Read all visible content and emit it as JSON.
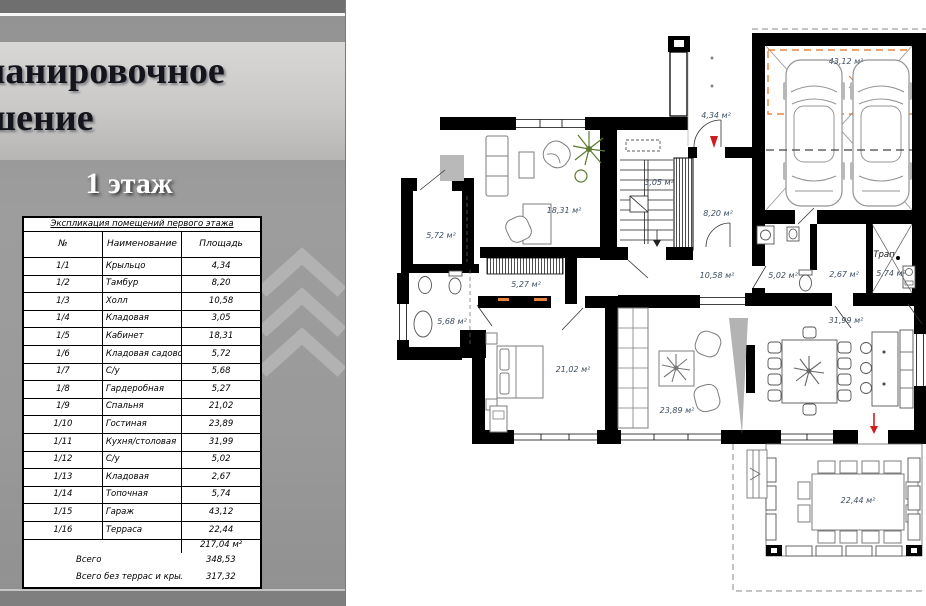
{
  "panel": {
    "title_line1": "ланировочное",
    "title_line2": "шение",
    "floor_label": "1 этаж",
    "table": {
      "title": "Экспликация помещений первого этажа",
      "columns": [
        "№",
        "Наименование",
        "Площадь"
      ],
      "rows": [
        [
          "1/1",
          "Крыльцо",
          "4,34"
        ],
        [
          "1/2",
          "Тамбур",
          "8,20"
        ],
        [
          "1/3",
          "Холл",
          "10,58"
        ],
        [
          "1/4",
          "Кладовая",
          "3,05"
        ],
        [
          "1/5",
          "Кабинет",
          "18,31"
        ],
        [
          "1/6",
          "Кладовая садового инвентаря",
          "5,72"
        ],
        [
          "1/7",
          "С/у",
          "5,68"
        ],
        [
          "1/8",
          "Гардеробная",
          "5,27"
        ],
        [
          "1/9",
          "Спальня",
          "21,02"
        ],
        [
          "1/10",
          "Гостиная",
          "23,89"
        ],
        [
          "1/11",
          "Кухня/столовая",
          "31,99"
        ],
        [
          "1/12",
          "С/у",
          "5,02"
        ],
        [
          "1/13",
          "Кладовая",
          "2,67"
        ],
        [
          "1/14",
          "Топочная",
          "5,74"
        ],
        [
          "1/15",
          "Гараж",
          "43,12"
        ],
        [
          "1/16",
          "Терраса",
          "22,44"
        ]
      ],
      "subtotal_area": "217,04 м²",
      "totals": [
        {
          "label": "Всего",
          "value": "348,53"
        },
        {
          "label": "Всего без террас и крылец",
          "value": "317,32"
        }
      ]
    }
  },
  "plan": {
    "room_labels": [
      {
        "text": "43,12 м²",
        "x": 846,
        "y": 64
      },
      {
        "text": "4,34 м²",
        "x": 716,
        "y": 118
      },
      {
        "text": "18,31 м²",
        "x": 564,
        "y": 213
      },
      {
        "text": "3,05 м²",
        "x": 659,
        "y": 185
      },
      {
        "text": "8,20 м²",
        "x": 718,
        "y": 216
      },
      {
        "text": "5,72 м²",
        "x": 441,
        "y": 238
      },
      {
        "text": "10,58 м²",
        "x": 717,
        "y": 278
      },
      {
        "text": "5,02 м²",
        "x": 783,
        "y": 278
      },
      {
        "text": "2,67 м²",
        "x": 844,
        "y": 277
      },
      {
        "text": "5,74 м²",
        "x": 891,
        "y": 276
      },
      {
        "text": "Трап",
        "x": 884,
        "y": 257,
        "cls": "trap"
      },
      {
        "text": "5,27 м²",
        "x": 526,
        "y": 287
      },
      {
        "text": "31,99 м²",
        "x": 846,
        "y": 323
      },
      {
        "text": "5,68 м²",
        "x": 452,
        "y": 324
      },
      {
        "text": "21,02 м²",
        "x": 573,
        "y": 372
      },
      {
        "text": "23,89 м²",
        "x": 677,
        "y": 413
      },
      {
        "text": "22,44 м²",
        "x": 858,
        "y": 503
      }
    ],
    "colors": {
      "wall": "#000000",
      "area_label": "#3d4e63",
      "parking": "#e8833c",
      "marker_red": "#cc2020"
    }
  }
}
